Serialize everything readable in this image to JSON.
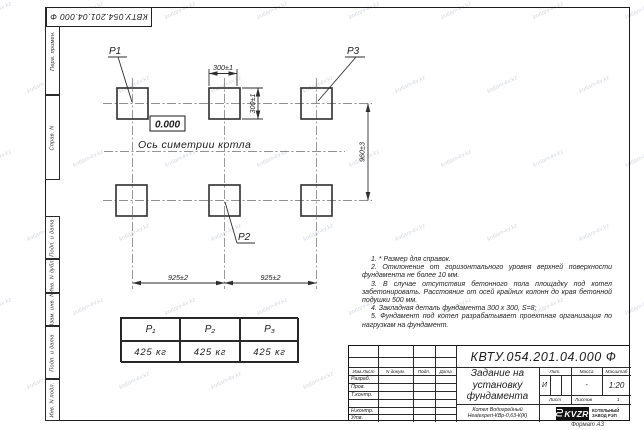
{
  "watermark": {
    "text": "kotlam-kv.kz"
  },
  "corner_stamp": {
    "doc_number": "КВТУ.054.201.04.000  Ф"
  },
  "side_strip": {
    "top": [
      "Перв. примен.",
      "Справ. N"
    ],
    "bottom": [
      "Подп. и дата",
      "Инв. N дубл.",
      "Взам. инв. N",
      "Подп. и дата",
      "Инв. N подл."
    ]
  },
  "drawing": {
    "point_labels": {
      "p1": "P1",
      "p2": "P2",
      "p3": "P3"
    },
    "level_mark": "0.000",
    "axis_label": "Ось симетрии котла",
    "dims": {
      "pad_width": "300±1",
      "pad_height": "300±1",
      "row_spacing": "960±3",
      "col_spacing_left": "925±2",
      "col_spacing_right": "925±2"
    }
  },
  "load_table": {
    "headers": [
      "P₁",
      "P₂",
      "P₃"
    ],
    "values": [
      "425 кг",
      "425 кг",
      "425 кг"
    ]
  },
  "notes": [
    "1. * Размер для справок.",
    "2. Отклонение от горизонтального уровня верхней поверхности фундамента не более 10 мм.",
    "3. В случае отсутствия бетонного пола площадку под котел забетонировать. Расстояние от осей крайних колонн до края бетонной подушки 500 мм.",
    "4. Закладная деталь фундамента  300 х 300, S=8;",
    "5. Фундамент под котел разрабатывает проектная организация по нагрузкам на фундамент."
  ],
  "title_block": {
    "doc_number": "КВТУ.054.201.04.000  Ф",
    "title_lines": [
      "Задание на",
      "установку",
      "фундамента"
    ],
    "product_lines": [
      "Котел Водогрейный",
      "Heatexpert-КВр-0,63-К(К)"
    ],
    "header_cols": [
      "Изм.Лист",
      "N докум.",
      "Подп.",
      "Дата"
    ],
    "row_labels": [
      "Разраб.",
      "Пров.",
      "Т.контр.",
      "",
      "Н.контр.",
      "Утв."
    ],
    "lit_label": "Лит.",
    "mass_label": "Масса",
    "scale_label": "Масштаб",
    "lit_value": "И",
    "mass_value": "-",
    "scale_value": "1:20",
    "sheet_label": "Лист",
    "sheets_label": "Листов",
    "sheets_value": "1",
    "logo": {
      "name": "KVZR",
      "caption_lines": [
        "КОТЕЛЬНЫЙ",
        "ЗАВОД РЭП"
      ]
    },
    "format_label": "Формат А3"
  }
}
